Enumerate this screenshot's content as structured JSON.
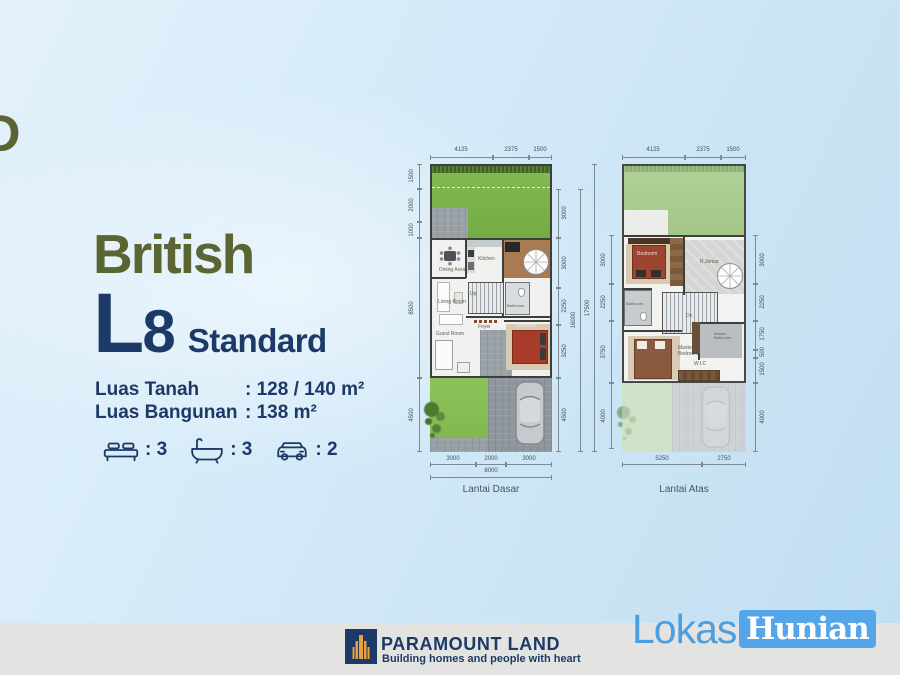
{
  "hero": {
    "cropped_letter": "D",
    "title": "British",
    "model_letter": "L",
    "model_number": "8",
    "model_suffix": "Standard",
    "specs": [
      {
        "label": "Luas Tanah",
        "value": ": 128 / 140 m²"
      },
      {
        "label": "Luas Bangunan",
        "value": ": 138 m²"
      }
    ],
    "features": [
      {
        "icon": "bed-icon",
        "count": ": 3"
      },
      {
        "icon": "bathtub-icon",
        "count": ": 3"
      },
      {
        "icon": "car-icon",
        "count": ": 2"
      }
    ]
  },
  "plans": [
    {
      "label": "Lantai Dasar",
      "top_dims": [
        "4125",
        "2375",
        "1500"
      ],
      "left_dims": [
        "1500",
        "2000",
        "1000",
        "8500",
        "4500"
      ],
      "right_dims": [
        "3000",
        "3000",
        "2250",
        "3250",
        "4500"
      ],
      "right_total_inner": "16000",
      "right_total_outer": "17500",
      "bottom_dims": [
        "3000",
        "2000",
        "3000"
      ],
      "bottom_total": "8000",
      "rooms": {
        "dining": "Dining Area",
        "kitchen": "Kitchen",
        "living": "Living Room",
        "guest": "Guest Room",
        "foyer": "Foyer",
        "bathroom": "Bathroom",
        "bedroom": "Bedroom",
        "up": "Up"
      }
    },
    {
      "label": "Lantai Atas",
      "top_dims": [
        "4125",
        "2375",
        "1500"
      ],
      "left_dims": [
        "3000",
        "2250",
        "3750",
        "4000"
      ],
      "right_dims": [
        "3000",
        "2250",
        "1750",
        "500",
        "1500",
        "4000"
      ],
      "bottom_dims": [
        "5250",
        "2750"
      ],
      "rooms": {
        "bedroom": "Bedroom",
        "jemur": "R.Jemur",
        "bathroom": "Bathroom",
        "dn": "Dn",
        "master": "Master Bedroom",
        "masterbath": "Master Bathroom",
        "wic": "W.I.C"
      }
    }
  ],
  "footer": {
    "brand": "PARAMOUNT LAND",
    "tagline": "Building homes and people with heart",
    "mark_light": "Lokasi",
    "mark_dark": "Hunian"
  },
  "colors": {
    "navy": "#1d3a66",
    "olive": "#5b6533",
    "accent_blue": "#4a9fe2",
    "grass": "#7cb44c"
  }
}
